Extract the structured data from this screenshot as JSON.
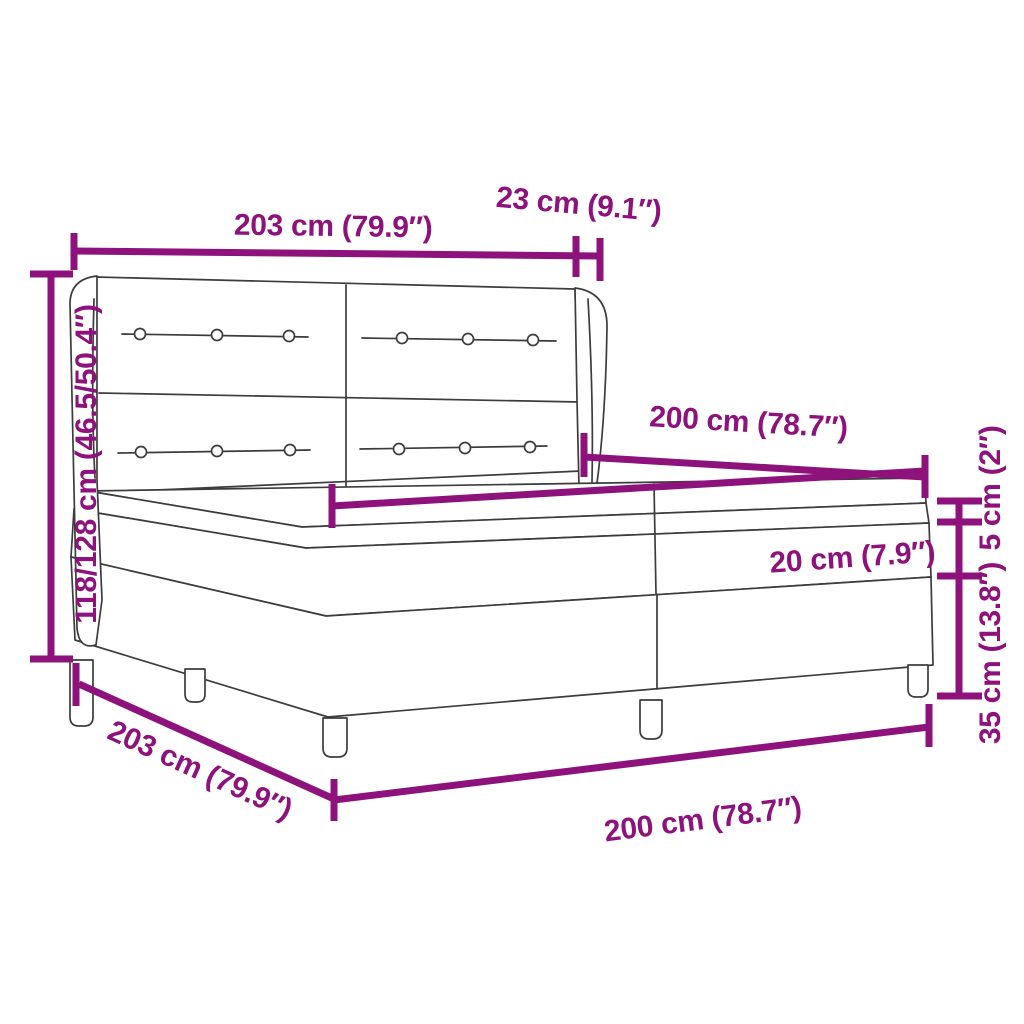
{
  "colors": {
    "dimension_accent": "#8D127C",
    "line_art": "#3C3C3C",
    "background": "#FFFFFF"
  },
  "diagram": {
    "type": "product-dimension-diagram",
    "subject": "box spring bed with winged tufted headboard, two-piece base, topper and five legs",
    "units": "cm and inches",
    "dimensions": [
      {
        "id": "headboard-width",
        "label": "203 cm (79.9″)",
        "value_cm": "203",
        "value_in": "79.9"
      },
      {
        "id": "wing-depth",
        "label": "23 cm (9.1″)",
        "value_cm": "23",
        "value_in": "9.1"
      },
      {
        "id": "total-height",
        "label": "118/128 cm (46.5/50.4″)",
        "value_cm": "118/128",
        "value_in": "46.5/50.4"
      },
      {
        "id": "bed-length-top",
        "label": "200 cm (78.7″)",
        "value_cm": "200",
        "value_in": "78.7"
      },
      {
        "id": "mattress-width",
        "label": "200 cm (78.7″)",
        "value_cm": "200",
        "value_in": "78.7"
      },
      {
        "id": "mattress-height",
        "label": "20 cm (7.9″)",
        "value_cm": "20",
        "value_in": "7.9"
      },
      {
        "id": "topper-height",
        "label": "5 cm (2″)",
        "value_cm": "5",
        "value_in": "2"
      },
      {
        "id": "base-height",
        "label": "35 cm (13.8″)",
        "value_cm": "35",
        "value_in": "13.8"
      },
      {
        "id": "base-width-diagonal",
        "label": "203 cm (79.9″)",
        "value_cm": "203",
        "value_in": "79.9"
      },
      {
        "id": "base-length-bottom",
        "label": "200 cm (78.7″)",
        "value_cm": "200",
        "value_in": "78.7"
      }
    ]
  }
}
